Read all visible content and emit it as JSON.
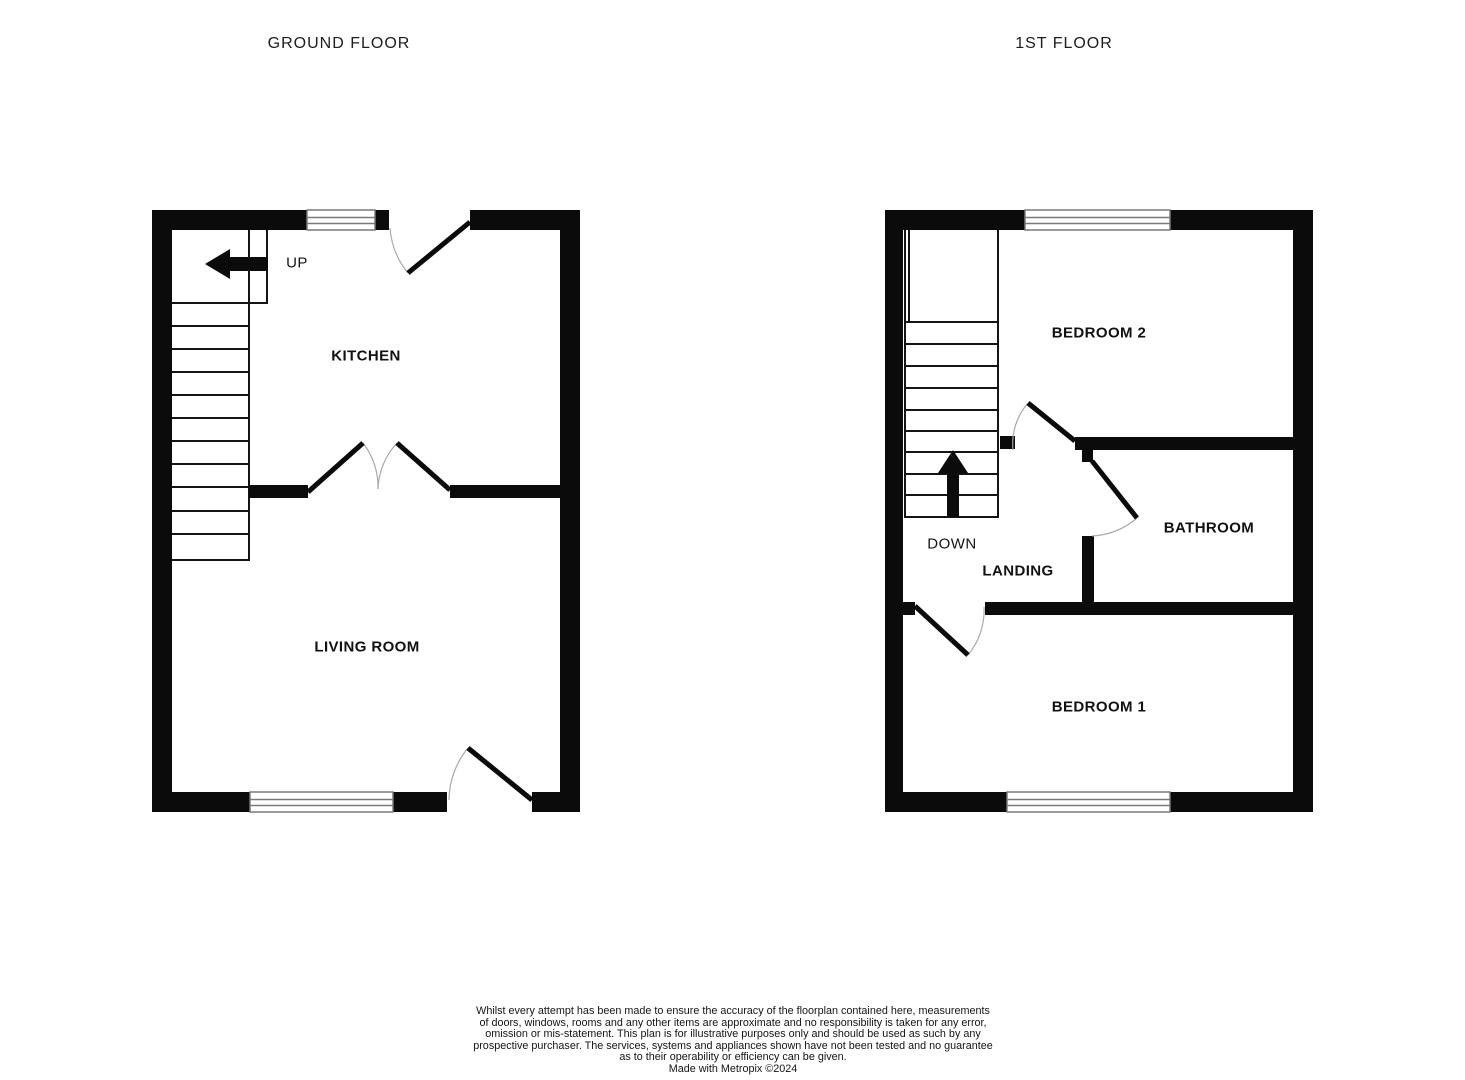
{
  "colors": {
    "wall": "#0b0b0b",
    "line": "#141414",
    "door": "#0b0b0b",
    "arc": "#a9a9a9",
    "window_border": "#7a7a7a",
    "text": "#171717"
  },
  "floors": [
    {
      "id": "ground-floor",
      "title": "GROUND FLOOR",
      "stair_label": "UP",
      "rooms": [
        {
          "label": "KITCHEN"
        },
        {
          "label": "LIVING ROOM"
        }
      ],
      "geometry": {
        "stair_boxes": [
          {
            "x": 171,
            "y": 228,
            "w": 96,
            "h": 75
          },
          {
            "x": 171,
            "y": 228,
            "w": 78,
            "h": 332
          }
        ],
        "stair_lines": [
          {
            "x1": 171,
            "y1": 303,
            "x2": 249,
            "y2": 303
          },
          {
            "x1": 171,
            "y1": 326,
            "x2": 249,
            "y2": 326
          },
          {
            "x1": 171,
            "y1": 349,
            "x2": 249,
            "y2": 349
          },
          {
            "x1": 171,
            "y1": 372,
            "x2": 249,
            "y2": 372
          },
          {
            "x1": 171,
            "y1": 395,
            "x2": 249,
            "y2": 395
          },
          {
            "x1": 171,
            "y1": 418,
            "x2": 249,
            "y2": 418
          },
          {
            "x1": 171,
            "y1": 441,
            "x2": 249,
            "y2": 441
          },
          {
            "x1": 171,
            "y1": 464,
            "x2": 249,
            "y2": 464
          },
          {
            "x1": 171,
            "y1": 487,
            "x2": 249,
            "y2": 487
          },
          {
            "x1": 171,
            "y1": 511,
            "x2": 249,
            "y2": 511
          },
          {
            "x1": 171,
            "y1": 534,
            "x2": 249,
            "y2": 534
          }
        ],
        "walls": [
          {
            "x": 152,
            "y": 210,
            "w": 20,
            "h": 602
          },
          {
            "x": 152,
            "y": 210,
            "w": 155,
            "h": 20
          },
          {
            "x": 375,
            "y": 210,
            "w": 14,
            "h": 20
          },
          {
            "x": 470,
            "y": 210,
            "w": 110,
            "h": 20
          },
          {
            "x": 560,
            "y": 210,
            "w": 20,
            "h": 602
          },
          {
            "x": 152,
            "y": 792,
            "w": 98,
            "h": 20
          },
          {
            "x": 393,
            "y": 792,
            "w": 54,
            "h": 20
          },
          {
            "x": 532,
            "y": 792,
            "w": 48,
            "h": 20
          },
          {
            "x": 249,
            "y": 485,
            "w": 59,
            "h": 13
          },
          {
            "x": 450,
            "y": 485,
            "w": 110,
            "h": 13
          }
        ],
        "windows": [
          {
            "x": 307,
            "y": 210,
            "w": 68,
            "h": 20
          },
          {
            "x": 250,
            "y": 792,
            "w": 143,
            "h": 20
          }
        ],
        "door_arcs": [
          {
            "x1": 390,
            "y1": 228,
            "x2": 408,
            "y2": 273,
            "r": 80,
            "sweep": 0
          },
          {
            "x1": 363,
            "y1": 443,
            "x2": 378,
            "y2": 489,
            "r": 72,
            "sweep": 1
          },
          {
            "x1": 397,
            "y1": 443,
            "x2": 378,
            "y2": 489,
            "r": 71,
            "sweep": 0
          },
          {
            "x1": 449,
            "y1": 800,
            "x2": 468,
            "y2": 748,
            "r": 83,
            "sweep": 1
          }
        ],
        "door_leaves": [
          {
            "x1": 470,
            "y1": 222,
            "x2": 408,
            "y2": 273
          },
          {
            "x1": 308,
            "y1": 492,
            "x2": 363,
            "y2": 443
          },
          {
            "x1": 450,
            "y1": 490,
            "x2": 397,
            "y2": 443
          },
          {
            "x1": 532,
            "y1": 800,
            "x2": 468,
            "y2": 748
          }
        ],
        "arrows": [
          {
            "name": "up-arrow-icon",
            "points": "205,264 230,249 230,257 268,257 268,271 230,271 230,279"
          }
        ]
      }
    },
    {
      "id": "first-floor",
      "title": "1ST FLOOR",
      "stair_label": "DOWN",
      "rooms": [
        {
          "label": "BEDROOM 2"
        },
        {
          "label": "BATHROOM"
        },
        {
          "label": "LANDING"
        },
        {
          "label": "BEDROOM 1"
        }
      ],
      "geometry": {
        "stair_boxes": [
          {
            "x": 905,
            "y": 228,
            "w": 93,
            "h": 289
          }
        ],
        "stair_lines": [
          {
            "x1": 909,
            "y1": 228,
            "x2": 909,
            "y2": 322
          },
          {
            "x1": 905,
            "y1": 322,
            "x2": 998,
            "y2": 322
          },
          {
            "x1": 905,
            "y1": 344,
            "x2": 998,
            "y2": 344
          },
          {
            "x1": 905,
            "y1": 366,
            "x2": 998,
            "y2": 366
          },
          {
            "x1": 905,
            "y1": 388,
            "x2": 998,
            "y2": 388
          },
          {
            "x1": 905,
            "y1": 410,
            "x2": 998,
            "y2": 410
          },
          {
            "x1": 905,
            "y1": 431,
            "x2": 998,
            "y2": 431
          },
          {
            "x1": 905,
            "y1": 452,
            "x2": 998,
            "y2": 452
          },
          {
            "x1": 905,
            "y1": 474,
            "x2": 998,
            "y2": 474
          },
          {
            "x1": 905,
            "y1": 495,
            "x2": 998,
            "y2": 495
          }
        ],
        "walls": [
          {
            "x": 885,
            "y": 210,
            "w": 18,
            "h": 602
          },
          {
            "x": 885,
            "y": 210,
            "w": 140,
            "h": 20
          },
          {
            "x": 1170,
            "y": 210,
            "w": 143,
            "h": 20
          },
          {
            "x": 1293,
            "y": 210,
            "w": 20,
            "h": 602
          },
          {
            "x": 885,
            "y": 792,
            "w": 122,
            "h": 20
          },
          {
            "x": 1170,
            "y": 792,
            "w": 143,
            "h": 20
          },
          {
            "x": 1000,
            "y": 436,
            "w": 15,
            "h": 13
          },
          {
            "x": 1075,
            "y": 437,
            "w": 218,
            "h": 13
          },
          {
            "x": 1082,
            "y": 450,
            "w": 11,
            "h": 12
          },
          {
            "x": 1082,
            "y": 536,
            "w": 12,
            "h": 79
          },
          {
            "x": 903,
            "y": 602,
            "w": 12,
            "h": 13
          },
          {
            "x": 985,
            "y": 602,
            "w": 308,
            "h": 13
          }
        ],
        "windows": [
          {
            "x": 1025,
            "y": 210,
            "w": 145,
            "h": 20
          },
          {
            "x": 1007,
            "y": 792,
            "w": 163,
            "h": 20
          }
        ],
        "door_arcs": [
          {
            "x1": 1013,
            "y1": 450,
            "x2": 1028,
            "y2": 403,
            "r": 62,
            "sweep": 1
          },
          {
            "x1": 1092,
            "y1": 536,
            "x2": 1137,
            "y2": 518,
            "r": 75,
            "sweep": 0
          },
          {
            "x1": 984,
            "y1": 607,
            "x2": 968,
            "y2": 655,
            "r": 70,
            "sweep": 1
          }
        ],
        "door_leaves": [
          {
            "x1": 1075,
            "y1": 441,
            "x2": 1028,
            "y2": 403
          },
          {
            "x1": 1092,
            "y1": 461,
            "x2": 1137,
            "y2": 518
          },
          {
            "x1": 915,
            "y1": 606,
            "x2": 968,
            "y2": 655
          }
        ],
        "arrows": [
          {
            "name": "down-arrow-icon",
            "points": "953,450 968,473 959,473 959,517 947,517 947,473 938,473"
          }
        ]
      }
    }
  ],
  "disclaimer": {
    "lines": [
      "Whilst every attempt has been made to ensure the accuracy of the floorplan contained here, measurements",
      "of doors, windows, rooms and any other items are approximate and no responsibility is taken for any error,",
      "omission or mis-statement. This plan is for illustrative purposes only and should be used as such by any",
      "prospective purchaser. The services, systems and appliances shown have not been tested and no guarantee",
      "as to their operability or efficiency can be given."
    ],
    "credit": "Made with Metropix ©2024"
  }
}
